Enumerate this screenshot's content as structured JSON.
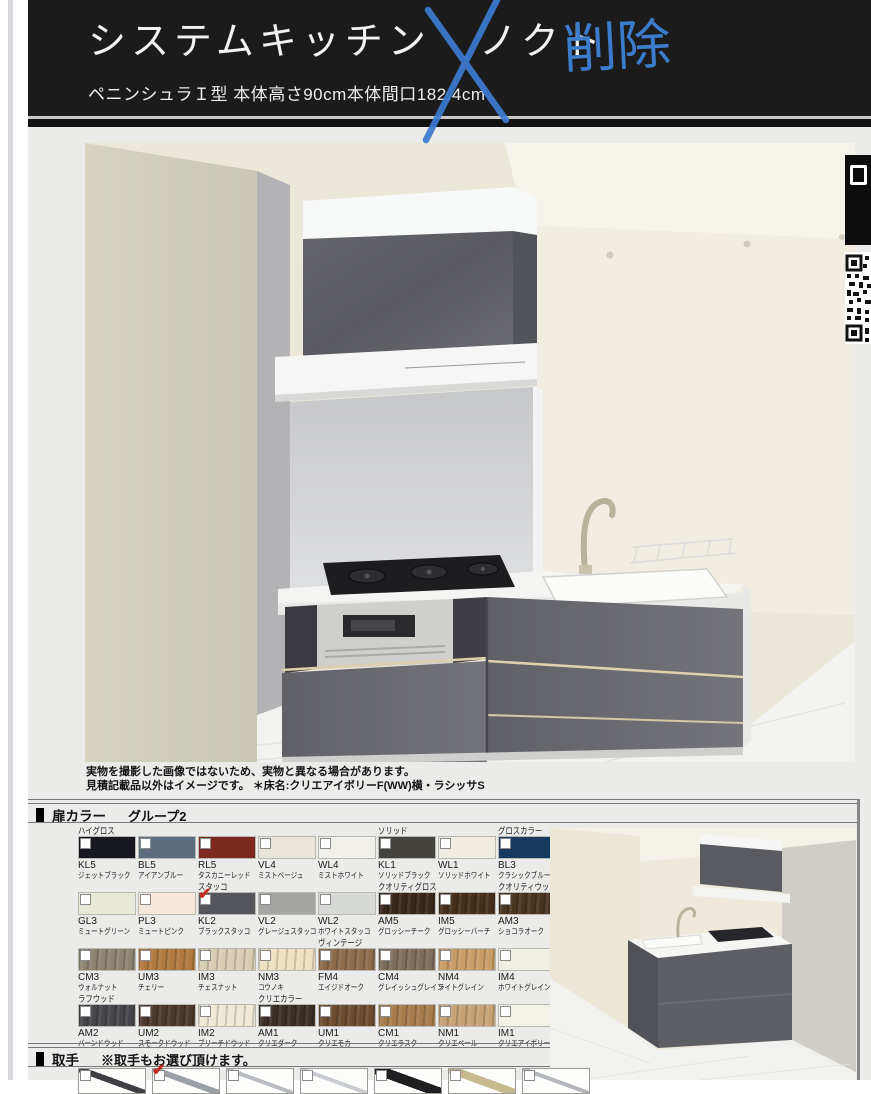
{
  "header": {
    "title": "システムキッチン",
    "product_name": "ノクト",
    "handwritten_note": "削除",
    "annotation_color": "#3c7bd0",
    "subtitle": "ペニンシュラＩ型 本体高さ90cm本体間口182.4cm"
  },
  "main_image": {
    "notes_line1": "実物を撮影した画像ではないため、実物と異なる場合があります。",
    "notes_line2": "見積記載品以外はイメージです。 ＊床名:クリエアイボリーF(WW)横・ラシッサS"
  },
  "door_colors": {
    "section_title": "扉カラー",
    "section_group": "グループ2",
    "selected_code": "KL2",
    "check_color": "#c4281c",
    "rows": [
      [
        {
          "group": "ハイグロス",
          "code": "KL5",
          "name": "ジェットブラック",
          "color": "#17171f",
          "checked": false,
          "wood": false
        },
        {
          "group": "",
          "code": "BL5",
          "name": "アイアンブルー",
          "color": "#5d6c7e",
          "checked": false,
          "wood": false
        },
        {
          "group": "",
          "code": "RL5",
          "name": "タスカニーレッド",
          "color": "#7c2a1d",
          "checked": false,
          "wood": false
        },
        {
          "group": "",
          "code": "VL4",
          "name": "ミストベージュ",
          "color": "#e9e5da",
          "checked": false,
          "wood": false
        },
        {
          "group": "",
          "code": "WL4",
          "name": "ミストホワイト",
          "color": "#f2f0ea",
          "checked": false,
          "wood": false
        },
        {
          "group": "ソリッド",
          "code": "KL1",
          "name": "ソリッドブラック",
          "color": "#45433e",
          "checked": false,
          "wood": false
        },
        {
          "group": "",
          "code": "WL1",
          "name": "ソリッドホワイト",
          "color": "#f0ece1",
          "checked": false,
          "wood": false
        },
        {
          "group": "グロスカラー",
          "code": "BL3",
          "name": "クラシックブルー",
          "color": "#16395f",
          "checked": false,
          "wood": false
        }
      ],
      [
        {
          "group": "",
          "code": "GL3",
          "name": "ミュートグリーン",
          "color": "#e9e9d8",
          "checked": false,
          "wood": false
        },
        {
          "group": "",
          "code": "PL3",
          "name": "ミュートピンク",
          "color": "#f6e9dc",
          "checked": false,
          "wood": false
        },
        {
          "group": "スタッコ",
          "code": "KL2",
          "name": "ブラックスタッコ",
          "color": "#55565c",
          "checked": true,
          "wood": false
        },
        {
          "group": "",
          "code": "VL2",
          "name": "グレージュスタッコ",
          "color": "#a5a5a3",
          "checked": false,
          "wood": false
        },
        {
          "group": "",
          "code": "WL2",
          "name": "ホワイトスタッコ",
          "color": "#d6d9d6",
          "checked": false,
          "wood": false
        },
        {
          "group": "クオリティグロス",
          "code": "AM5",
          "name": "グロッシーチーク",
          "color": "#38281a",
          "checked": false,
          "wood": true
        },
        {
          "group": "",
          "code": "IM5",
          "name": "グロッシーバーチ",
          "color": "#46301b",
          "checked": false,
          "wood": true
        },
        {
          "group": "クオリティウッド",
          "code": "AM3",
          "name": "ショコラオーク",
          "color": "#493420",
          "checked": false,
          "wood": true
        }
      ],
      [
        {
          "group": "",
          "code": "CM3",
          "name": "ウォルナット",
          "color": "#8d8371",
          "checked": false,
          "wood": true
        },
        {
          "group": "",
          "code": "UM3",
          "name": "チェリー",
          "color": "#b1793f",
          "checked": false,
          "wood": true
        },
        {
          "group": "",
          "code": "IM3",
          "name": "チェスナット",
          "color": "#d8ccb3",
          "checked": false,
          "wood": true
        },
        {
          "group": "",
          "code": "NM3",
          "name": "コウノキ",
          "color": "#eee1c3",
          "checked": false,
          "wood": true
        },
        {
          "group": "ヴィンテージ",
          "code": "FM4",
          "name": "エイジドオーク",
          "color": "#8c6c49",
          "checked": false,
          "wood": true
        },
        {
          "group": "",
          "code": "CM4",
          "name": "グレイッシュグレイン",
          "color": "#7d6e5c",
          "checked": false,
          "wood": true
        },
        {
          "group": "",
          "code": "NM4",
          "name": "ライトグレイン",
          "color": "#c79c67",
          "checked": false,
          "wood": true
        },
        {
          "group": "",
          "code": "IM4",
          "name": "ホワイトグレイン",
          "color": "#f1eee3",
          "checked": false,
          "wood": false
        }
      ],
      [
        {
          "group": "ラフウッド",
          "code": "AM2",
          "name": "バーンドウッド",
          "color": "#46464a",
          "checked": false,
          "wood": true
        },
        {
          "group": "",
          "code": "UM2",
          "name": "スモークドウッド",
          "color": "#4a382a",
          "checked": false,
          "wood": true
        },
        {
          "group": "",
          "code": "IM2",
          "name": "ブリーチドウッド",
          "color": "#efe9d6",
          "checked": false,
          "wood": true
        },
        {
          "group": "クリエカラー",
          "code": "AM1",
          "name": "クリエダーク",
          "color": "#3a2f25",
          "checked": false,
          "wood": true
        },
        {
          "group": "",
          "code": "UM1",
          "name": "クリエモカ",
          "color": "#6b4c2e",
          "checked": false,
          "wood": true
        },
        {
          "group": "",
          "code": "CM1",
          "name": "クリエラスク",
          "color": "#a67c4c",
          "checked": false,
          "wood": true
        },
        {
          "group": "",
          "code": "NM1",
          "name": "クリエペール",
          "color": "#c8a276",
          "checked": false,
          "wood": true
        },
        {
          "group": "",
          "code": "IM1",
          "name": "クリエアイボリー",
          "color": "#f4f1e7",
          "checked": false,
          "wood": false
        }
      ]
    ]
  },
  "handles": {
    "section_title": "取手",
    "note": "※取手もお選び頂けます。",
    "items": [
      {
        "checked": false,
        "color": "#3f4043",
        "thick": 3
      },
      {
        "checked": true,
        "color": "#9aa0a6",
        "thick": 3
      },
      {
        "checked": false,
        "color": "#b9bdc2",
        "thick": 2
      },
      {
        "checked": false,
        "color": "#c9ccd0",
        "thick": 2
      },
      {
        "checked": false,
        "color": "#1f1f22",
        "thick": 5
      },
      {
        "checked": false,
        "color": "#c6b98e",
        "thick": 4
      },
      {
        "checked": false,
        "color": "#b4b7bc",
        "thick": 2
      }
    ]
  }
}
